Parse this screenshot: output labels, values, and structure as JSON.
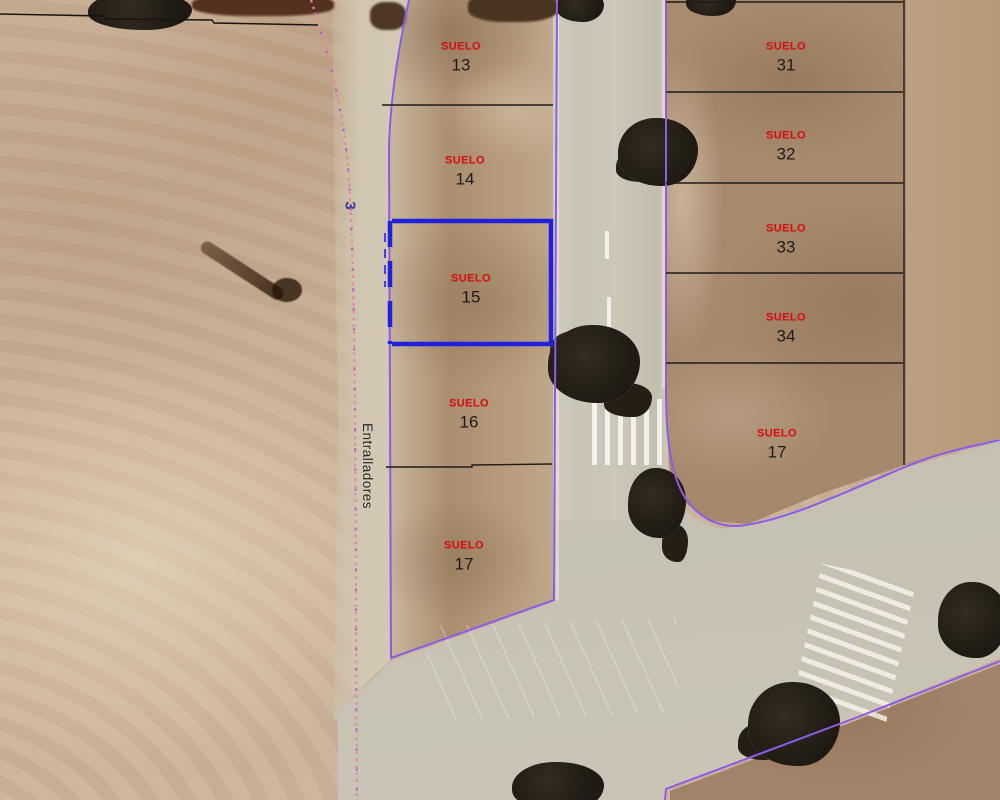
{
  "map": {
    "view_description": "Aerial orthophoto with cadastral parcel overlay",
    "street": {
      "name": "Entralladores",
      "number_label": "3"
    },
    "selected_parcel": "15",
    "parcels": [
      {
        "tag": "SUELO",
        "number": "13",
        "column": "left",
        "selected": false
      },
      {
        "tag": "SUELO",
        "number": "14",
        "column": "left",
        "selected": false
      },
      {
        "tag": "SUELO",
        "number": "15",
        "column": "left",
        "selected": true
      },
      {
        "tag": "SUELO",
        "number": "16",
        "column": "left",
        "selected": false
      },
      {
        "tag": "SUELO",
        "number": "17",
        "column": "left",
        "selected": false
      },
      {
        "tag": "SUELO",
        "number": "31",
        "column": "right",
        "selected": false
      },
      {
        "tag": "SUELO",
        "number": "32",
        "column": "right",
        "selected": false
      },
      {
        "tag": "SUELO",
        "number": "33",
        "column": "right",
        "selected": false
      },
      {
        "tag": "SUELO",
        "number": "34",
        "column": "right",
        "selected": false
      },
      {
        "tag": "SUELO",
        "number": "17",
        "column": "right",
        "selected": false
      }
    ],
    "colors": {
      "parcel_label_red": "#e01010",
      "parcel_number_black": "#1c1c1c",
      "selected_outline_blue": "#2020dd",
      "boundary_purple": "#8a5ce8",
      "divider_black": "#1c1c1c",
      "dotted_path_pink": "#f07fa8",
      "street_text_black": "#252525",
      "road_number_blue": "#3b3a96"
    }
  }
}
